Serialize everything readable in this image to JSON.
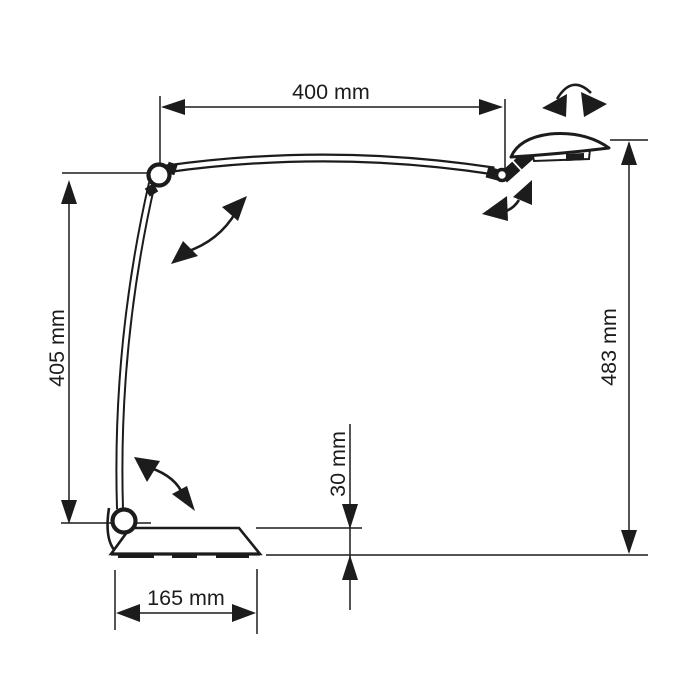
{
  "page": {
    "background": "#ffffff",
    "line_color": "#1c1c1c"
  },
  "diagram": {
    "type": "technical-dimension-drawing",
    "subject": "articulated desk lamp, side view",
    "unit": "mm",
    "dimensions": [
      {
        "name": "upper-arm-reach",
        "label": "400 mm",
        "value": 400,
        "orientation": "horizontal"
      },
      {
        "name": "lower-arm-height",
        "label": "405 mm",
        "value": 405,
        "orientation": "vertical"
      },
      {
        "name": "overall-height",
        "label": "483 mm",
        "value": 483,
        "orientation": "vertical"
      },
      {
        "name": "base-clearance",
        "label": "30 mm",
        "value": 30,
        "orientation": "vertical"
      },
      {
        "name": "base-depth",
        "label": "165 mm",
        "value": 165,
        "orientation": "horizontal"
      }
    ],
    "rotation_indicators": [
      "head-swivel-arrow",
      "head-tilt-arrow",
      "elbow-pivot-arrow",
      "base-pivot-arrow"
    ]
  }
}
